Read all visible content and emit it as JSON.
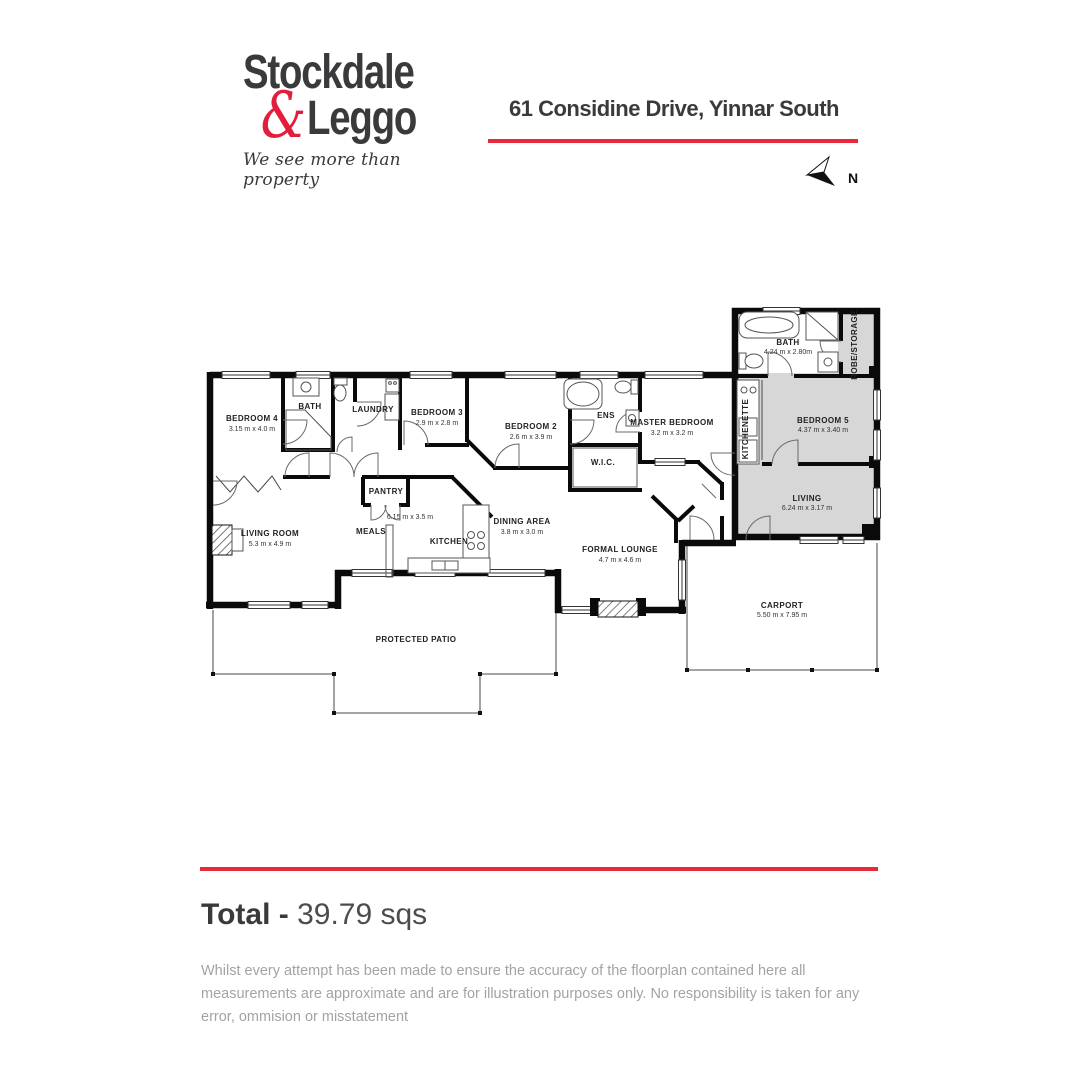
{
  "header": {
    "logo_line1": "Stockdale",
    "logo_amp": "&",
    "logo_line2": "Leggo",
    "tagline": "We see more than property",
    "address": "61 Considine Drive, Yinnar South",
    "north_label": "N"
  },
  "colors": {
    "accent_red": "#e8293b",
    "logo_red": "#e31e3c",
    "text_dark": "#3a3a3c",
    "wall_black": "#0a0a0a",
    "unit_gray": "#d7d7d7",
    "disclaimer_gray": "#a3a3a3"
  },
  "plan": {
    "rooms": [
      {
        "name": "BEDROOM 4",
        "dims": "3.15 m x 4.0 m"
      },
      {
        "name": "BATH",
        "dims": ""
      },
      {
        "name": "LAUNDRY",
        "dims": ""
      },
      {
        "name": "BEDROOM 3",
        "dims": "2.9 m x 2.8 m"
      },
      {
        "name": "BEDROOM 2",
        "dims": "2.6 m x 3.9 m"
      },
      {
        "name": "ENS",
        "dims": ""
      },
      {
        "name": "W.I.C.",
        "dims": ""
      },
      {
        "name": "MASTER BEDROOM",
        "dims": "3.2 m x 3.2 m"
      },
      {
        "name": "PANTRY",
        "dims": ""
      },
      {
        "name": "MEALS",
        "dims": ""
      },
      {
        "name": "",
        "dims": "6.15 m x 3.5 m"
      },
      {
        "name": "KITCHEN",
        "dims": ""
      },
      {
        "name": "LIVING ROOM",
        "dims": "5.3 m x 4.9 m"
      },
      {
        "name": "DINING AREA",
        "dims": "3.8 m x 3.0 m"
      },
      {
        "name": "FORMAL LOUNGE",
        "dims": "4.7 m x 4.6 m"
      },
      {
        "name": "PROTECTED PATIO",
        "dims": ""
      },
      {
        "name": "BATH",
        "dims": "4.24 m x 2.80m"
      },
      {
        "name": "ROBE/STORAGE",
        "dims": ""
      },
      {
        "name": "KITCHENETTE",
        "dims": ""
      },
      {
        "name": "BEDROOM 5",
        "dims": "4.37 m x 3.40 m"
      },
      {
        "name": "LIVING",
        "dims": "6.24 m x 3.17 m"
      },
      {
        "name": "CARPORT",
        "dims": "5.50 m x 7.95 m"
      }
    ]
  },
  "footer": {
    "total_label": "Total - ",
    "total_value": "39.79 sqs",
    "disclaimer": "Whilst every attempt has been made to ensure the accuracy of the floorplan contained here all measurements are approximate and are for illustration purposes only. No responsibility is taken for any error, ommision or misstatement"
  }
}
